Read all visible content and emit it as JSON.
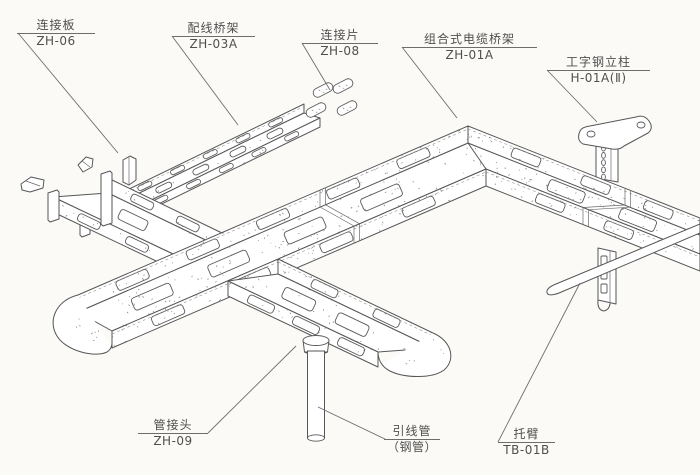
{
  "colors": {
    "line": "#565656",
    "paper": "#fbfaf7",
    "text": "#4f4f4f"
  },
  "callouts": [
    {
      "id": "connection-plate",
      "label": "连接板",
      "code": "ZH-06"
    },
    {
      "id": "wiring-tray",
      "label": "配线桥架",
      "code": "ZH-03A"
    },
    {
      "id": "connection-strip",
      "label": "连接片",
      "code": "ZH-08"
    },
    {
      "id": "combined-cable-tray",
      "label": "组合式电缆桥架",
      "code": "ZH-01A"
    },
    {
      "id": "i-beam-column",
      "label": "工字钢立柱",
      "code": "H-01A(Ⅱ)"
    },
    {
      "id": "pipe-joint",
      "label": "管接头",
      "code": "ZH-09"
    },
    {
      "id": "lead-wire-pipe",
      "label": "引线管",
      "code": "（钢管）"
    },
    {
      "id": "support-arm",
      "label": "托臂",
      "code": "TB-01B"
    }
  ]
}
